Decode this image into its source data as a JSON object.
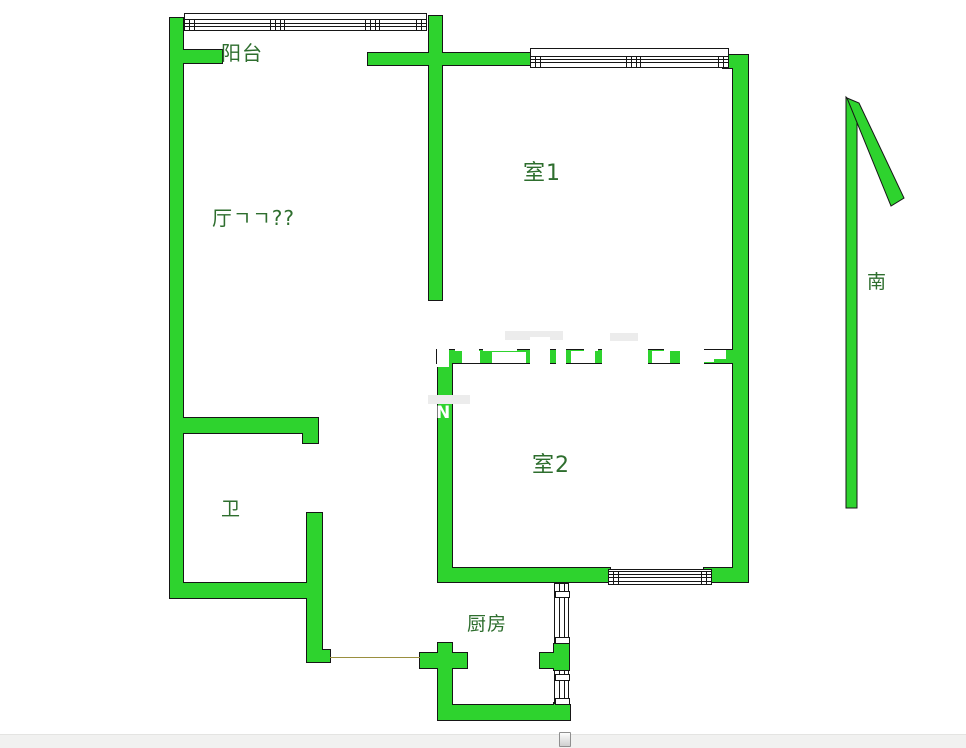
{
  "floorplan": {
    "colors": {
      "wall": "#2ed32e",
      "outline": "#161616",
      "label": "#2e6e2e",
      "door_line": "#9a8f3f",
      "watermark_white": "#ffffff",
      "watermark_gray": "#ececec"
    },
    "labels": [
      {
        "id": "balcony",
        "text": "阳台",
        "x": 221,
        "y": 37,
        "size": 20
      },
      {
        "id": "living-room",
        "text": "厅ㄱㄱ??",
        "x": 212,
        "y": 202,
        "size": 20
      },
      {
        "id": "room1",
        "text": "室1",
        "x": 523,
        "y": 155,
        "size": 22
      },
      {
        "id": "room2",
        "text": "室2",
        "x": 532,
        "y": 447,
        "size": 22
      },
      {
        "id": "bathroom",
        "text": "卫",
        "x": 221,
        "y": 494,
        "size": 19
      },
      {
        "id": "kitchen",
        "text": "厨房",
        "x": 467,
        "y": 609,
        "size": 19
      },
      {
        "id": "south",
        "text": "南",
        "x": 867,
        "y": 267,
        "size": 19
      }
    ],
    "walls": [
      [
        170,
        18,
        13,
        580
      ],
      [
        177,
        50,
        45,
        13
      ],
      [
        429,
        16,
        13,
        284
      ],
      [
        368,
        53,
        162,
        12
      ],
      [
        723,
        55,
        25,
        13
      ],
      [
        733,
        58,
        15,
        524
      ],
      [
        437,
        350,
        311,
        13
      ],
      [
        438,
        363,
        14,
        219
      ],
      [
        440,
        568,
        170,
        14
      ],
      [
        704,
        568,
        44,
        14
      ],
      [
        438,
        643,
        14,
        77
      ],
      [
        420,
        653,
        47,
        15
      ],
      [
        438,
        705,
        132,
        15
      ],
      [
        540,
        653,
        28,
        15
      ],
      [
        554,
        644,
        15,
        26
      ],
      [
        554,
        703,
        15,
        17
      ],
      [
        170,
        418,
        148,
        15
      ],
      [
        303,
        433,
        15,
        10
      ],
      [
        307,
        513,
        15,
        149
      ],
      [
        313,
        650,
        17,
        12
      ],
      [
        170,
        583,
        152,
        15
      ]
    ],
    "windows": [
      {
        "id": "balcony-window",
        "orient": "h",
        "x": 184,
        "y": 13,
        "w": 243,
        "h": 18,
        "lines": [
          5,
          9,
          12
        ],
        "mullions": [
          85,
          180
        ],
        "endblocks": true
      },
      {
        "id": "room1-window",
        "orient": "h",
        "x": 530,
        "y": 48,
        "w": 199,
        "h": 20,
        "lines": [
          7,
          10,
          13
        ],
        "mullions": [
          95
        ],
        "endblocks": true
      },
      {
        "id": "room2-window",
        "orient": "h",
        "x": 608,
        "y": 569,
        "w": 104,
        "h": 16,
        "lines": [
          1,
          4,
          7,
          11
        ],
        "mullions": [],
        "endblocks": true
      },
      {
        "id": "kitchen-window-upper",
        "orient": "v",
        "x": 554,
        "y": 583,
        "w": 15,
        "h": 61,
        "lines": [
          4,
          9
        ],
        "dividers": [
          7,
          53
        ]
      },
      {
        "id": "kitchen-window-lower",
        "orient": "v",
        "x": 554,
        "y": 670,
        "w": 15,
        "h": 34,
        "lines": [
          4,
          9
        ],
        "dividers": [
          3,
          27
        ]
      }
    ],
    "door_line": {
      "x": 330,
      "y": 657,
      "w": 90
    },
    "compass": {
      "vertical": "846,97 857,109 857,508 846,508",
      "diagonal": "847,98 859,103 904,198 891,206"
    },
    "watermark": {
      "n_text": "N",
      "n_pos": {
        "x": 436,
        "y": 405
      },
      "gray_blocks": [
        [
          505,
          331,
          58,
          9
        ],
        [
          610,
          333,
          28,
          8
        ],
        [
          428,
          395,
          42,
          9
        ]
      ],
      "white_blocks": [
        [
          437,
          343,
          12,
          24
        ],
        [
          455,
          337,
          24,
          14
        ],
        [
          462,
          351,
          18,
          12
        ],
        [
          483,
          340,
          34,
          11
        ],
        [
          492,
          352,
          34,
          11
        ],
        [
          530,
          337,
          20,
          27
        ],
        [
          556,
          343,
          10,
          21
        ],
        [
          571,
          351,
          24,
          12
        ],
        [
          584,
          339,
          14,
          12
        ],
        [
          602,
          347,
          46,
          17
        ],
        [
          652,
          351,
          18,
          12
        ],
        [
          664,
          341,
          30,
          10
        ],
        [
          680,
          345,
          24,
          19
        ],
        [
          688,
          350,
          26,
          12
        ],
        [
          712,
          350,
          14,
          9
        ]
      ]
    }
  },
  "scrollbar": {
    "orientation": "horizontal"
  }
}
